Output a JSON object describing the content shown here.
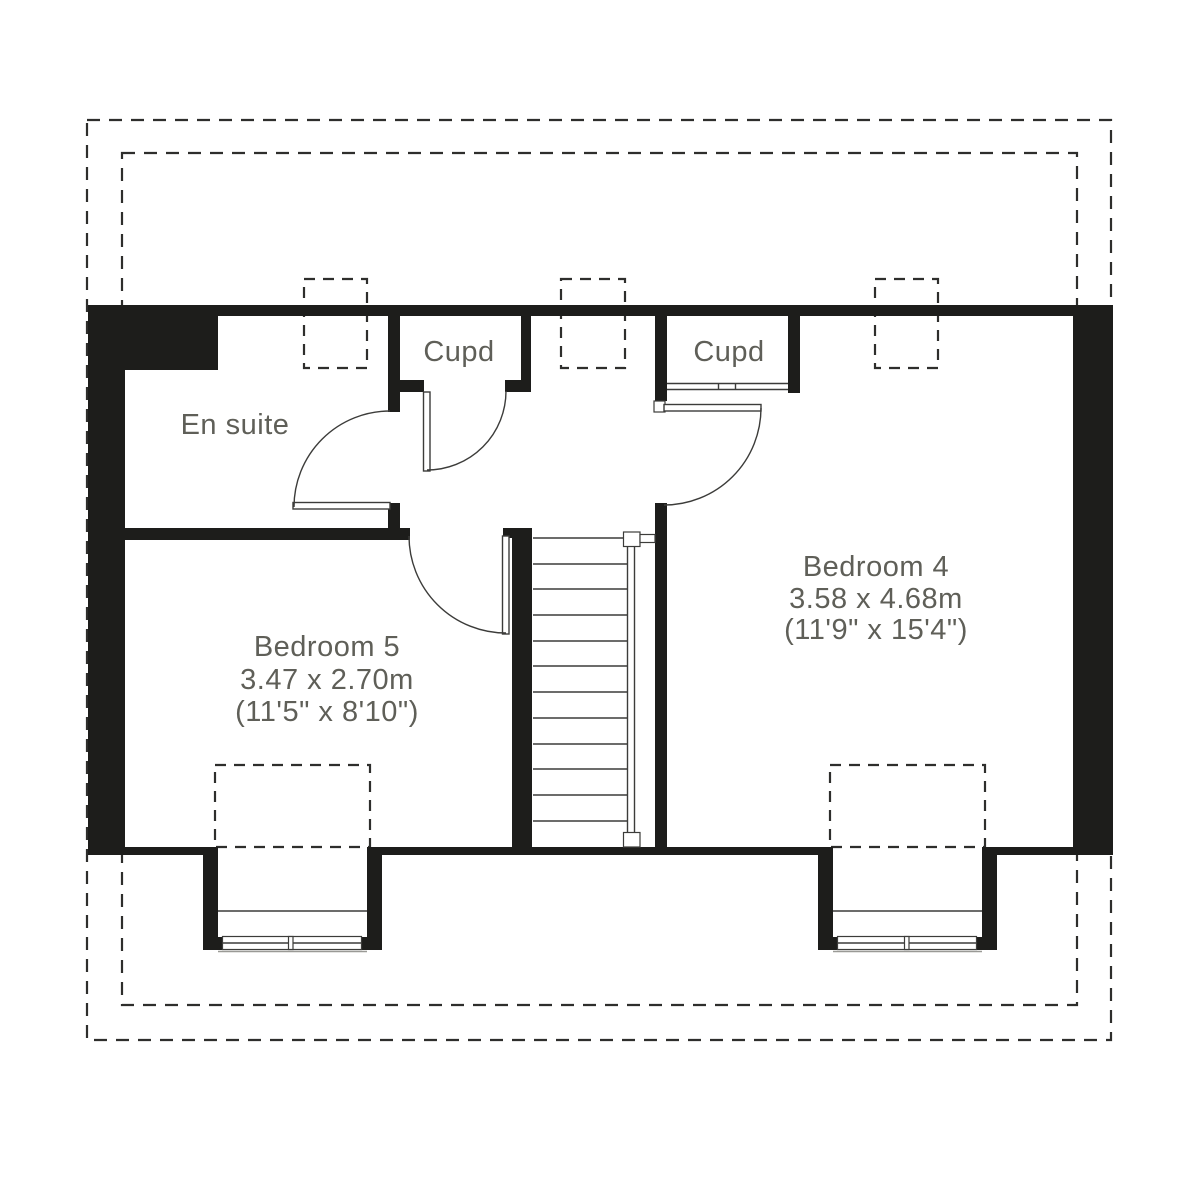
{
  "plan": {
    "title": "Attic floor plan",
    "rooms": {
      "en_suite": {
        "label": "En suite"
      },
      "cupboard_left": {
        "label": "Cupd"
      },
      "cupboard_right": {
        "label": "Cupd"
      },
      "bedroom5": {
        "name": "Bedroom 5",
        "metric": "3.47 x 2.70m",
        "imperial": "(11'5\" x 8'10\")"
      },
      "bedroom4": {
        "name": "Bedroom 4",
        "metric": "3.58 x 4.68m",
        "imperial": "(11'9\" x 15'4\")"
      }
    },
    "colors": {
      "wall": "#1d1d1b",
      "line": "#3c3c3a",
      "text": "#5f5f58",
      "dashed_outline": "#2e2e2c",
      "background": "#ffffff"
    }
  }
}
